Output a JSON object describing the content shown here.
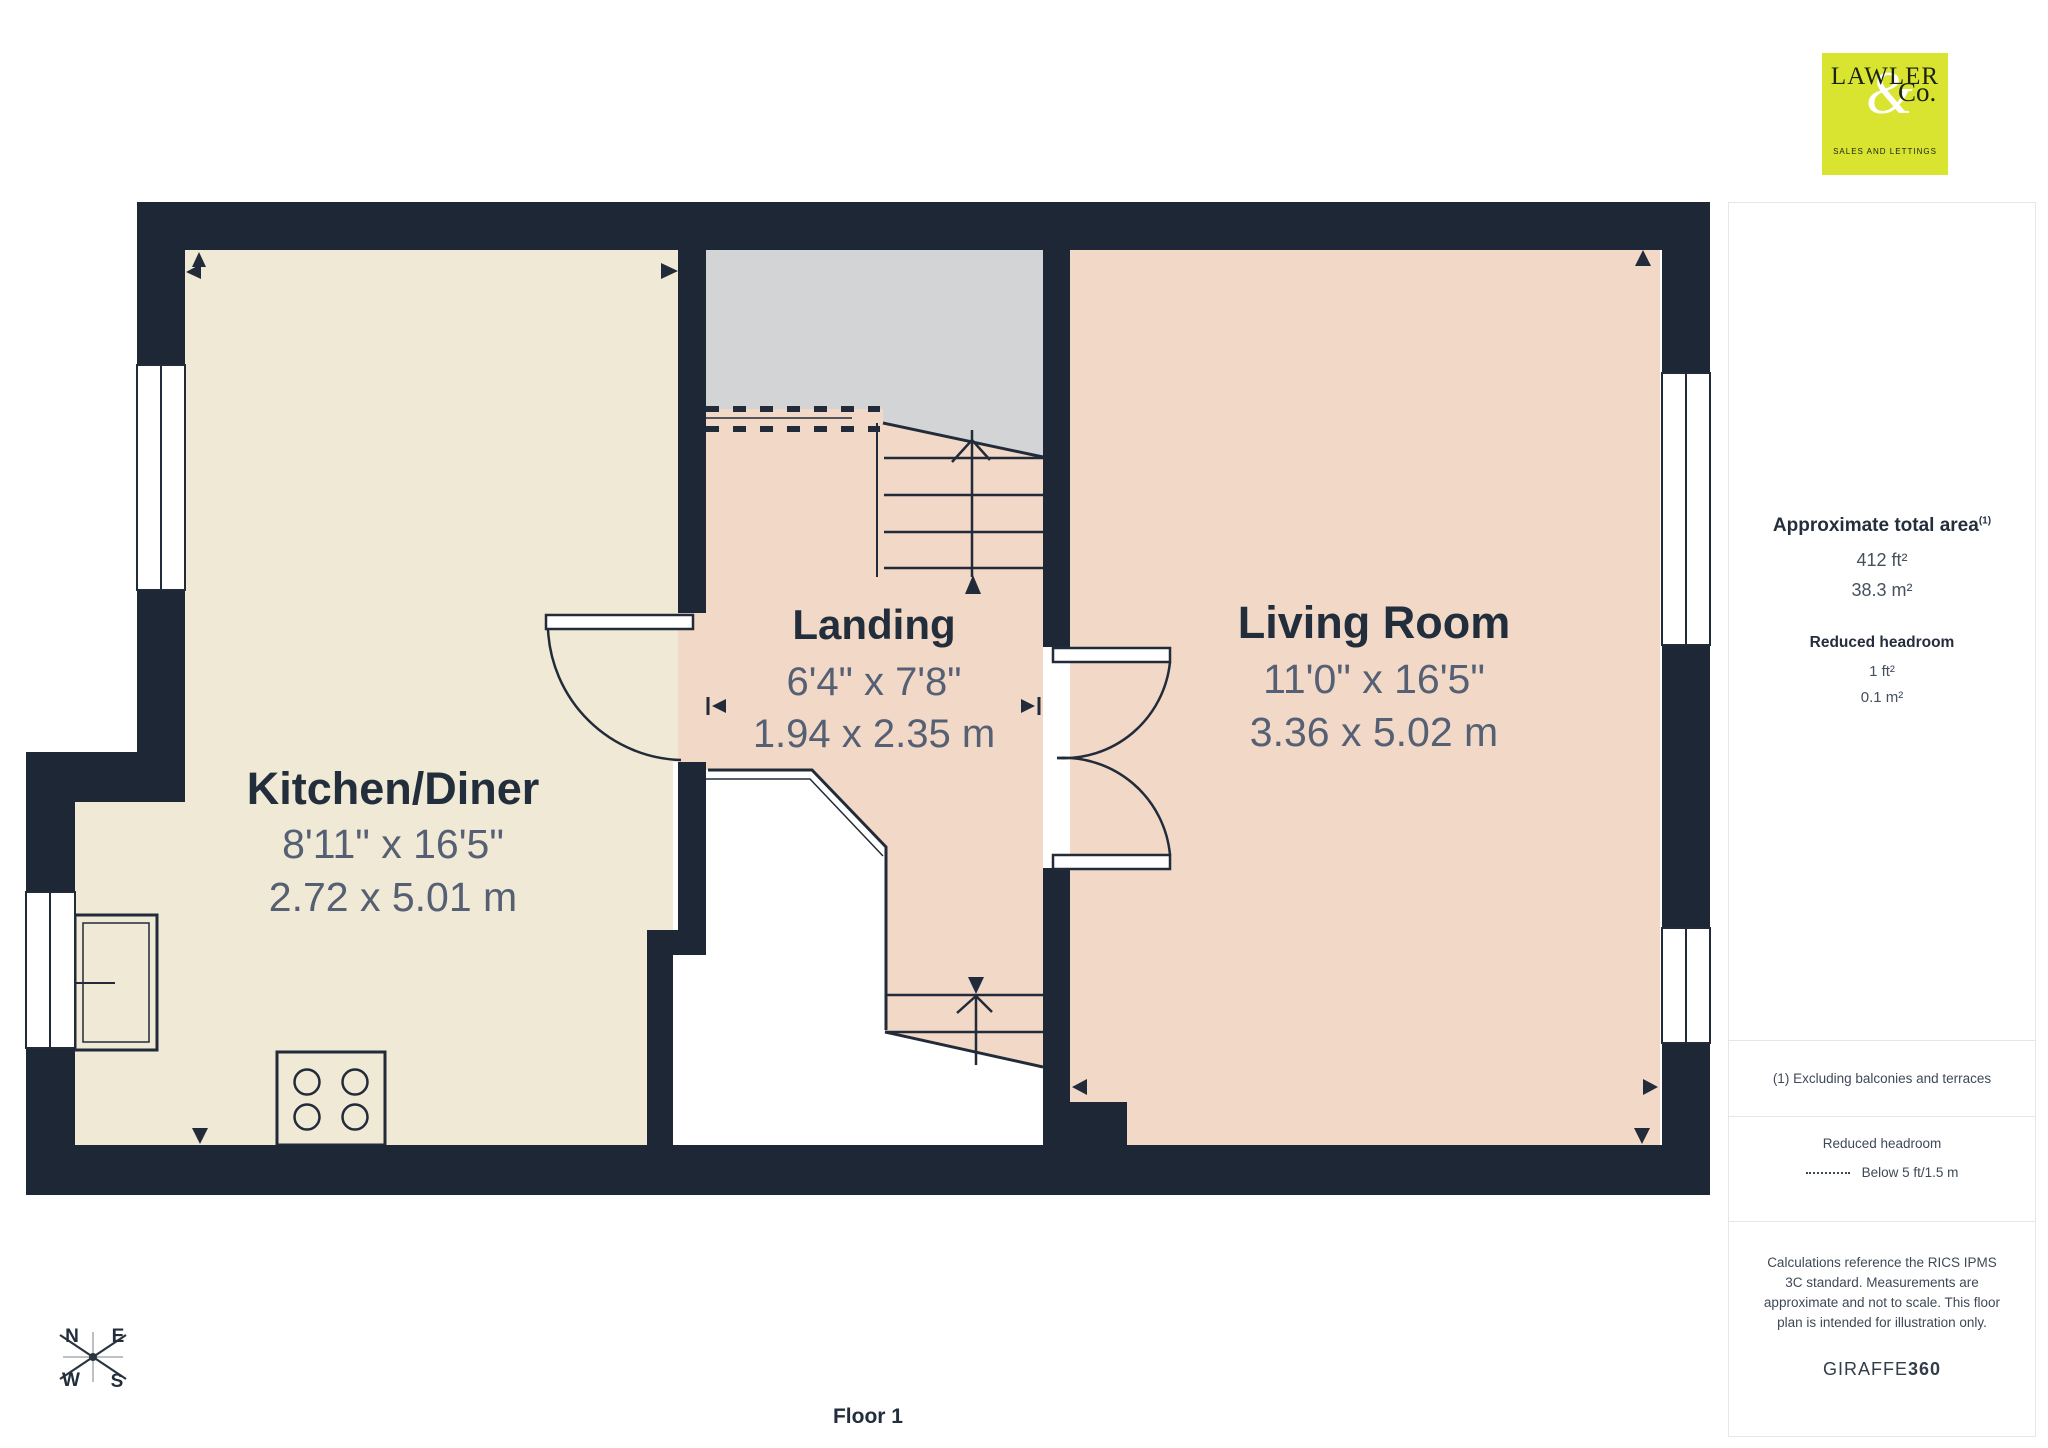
{
  "branding": {
    "logo_line1": "LAWLER",
    "logo_amp": "&",
    "logo_co": "Co.",
    "logo_tagline": "SALES AND LETTINGS",
    "logo_bg_color": "#d9e430"
  },
  "sidebar": {
    "total_area": {
      "heading": "Approximate total area",
      "footnote_marker": "(1)",
      "imperial": "412 ft²",
      "metric": "38.3 m²"
    },
    "reduced_headroom": {
      "heading": "Reduced headroom",
      "imperial": "1 ft²",
      "metric": "0.1 m²"
    },
    "footnote": "(1) Excluding balconies and terraces",
    "legend": {
      "title": "Reduced headroom",
      "item": "Below 5 ft/1.5 m"
    },
    "disclaimer": "Calculations reference the RICS IPMS 3C standard. Measurements are approximate and not to scale. This floor plan is intended for illustration only.",
    "brand_normal": "GIRAFFE",
    "brand_bold": "360"
  },
  "floor": {
    "label": "Floor 1"
  },
  "compass": {
    "n": "N",
    "e": "E",
    "s": "S",
    "w": "W"
  },
  "rooms": [
    {
      "name": "Kitchen/Diner",
      "imperial": "8'11\" x 16'5\"",
      "metric": "2.72 x 5.01 m"
    },
    {
      "name": "Landing",
      "imperial": "6'4\" x 7'8\"",
      "metric": "1.94 x 2.35 m"
    },
    {
      "name": "Living Room",
      "imperial": "11'0\" x 16'5\"",
      "metric": "3.36 x 5.02 m"
    }
  ],
  "colors": {
    "wall": "#1e2735",
    "kitchen_floor": "#f0e9d5",
    "landing_floor": "#f2d8c7",
    "living_floor": "#f2d8c7",
    "stair_void_gray": "#d3d4d6",
    "line": "#222b3a",
    "dim_text": "#566074",
    "dark_text": "#232e3c",
    "sidebar_border": "#e4e6e9",
    "sidebar_text": "#3e4956"
  }
}
